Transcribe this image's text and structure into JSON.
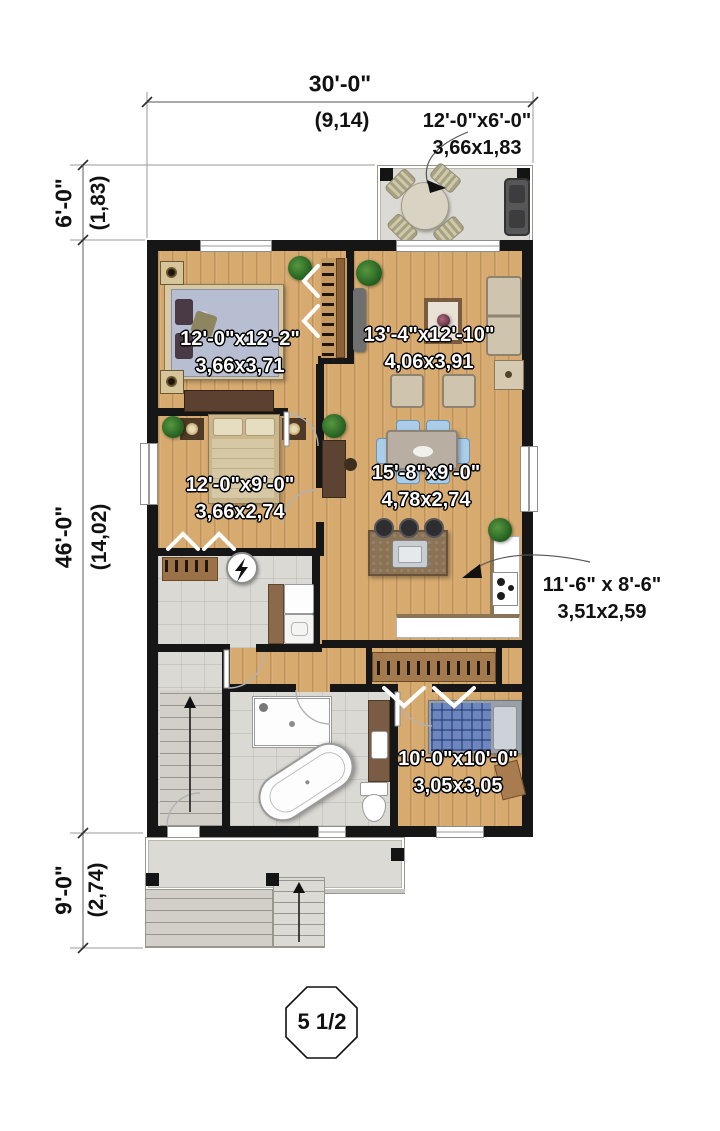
{
  "plan": {
    "badge": {
      "label": "5 1/2"
    },
    "dimensions": {
      "overall_width": {
        "imperial": "30'-0\"",
        "metric": "(9,14)"
      },
      "deck_depth": {
        "imperial": "6'-0\"",
        "metric": "(1,83)"
      },
      "house_depth": {
        "imperial": "46'-0\"",
        "metric": "(14,02)"
      },
      "porch_depth": {
        "imperial": "9'-0\"",
        "metric": "(2,74)"
      }
    },
    "rooms": {
      "deck": {
        "imperial": "12'-0\"x6'-0\"",
        "metric": "3,66x1,83"
      },
      "bedroom1": {
        "imperial": "12'-0\"x12'-2\"",
        "metric": "3,66x3,71"
      },
      "living": {
        "imperial": "13'-4\"x12'-10\"",
        "metric": "4,06x3,91"
      },
      "bedroom2": {
        "imperial": "12'-0\"x9'-0\"",
        "metric": "3,66x2,74"
      },
      "dining": {
        "imperial": "15'-8\"x9'-0\"",
        "metric": "4,78x2,74"
      },
      "kitchen": {
        "imperial": "11'-6\" x 8'-6\"",
        "metric": "3,51x2,59"
      },
      "bedroom3": {
        "imperial": "10'-0\"x10'-0\"",
        "metric": "3,05x3,05"
      }
    },
    "colors": {
      "wall": "#161616",
      "wood": "#d7ab70",
      "tile": "#dbd9d4",
      "deck": "#dcdad4",
      "chair_blue": "#aacde8",
      "bed_plaid": "#6d86bd"
    }
  }
}
